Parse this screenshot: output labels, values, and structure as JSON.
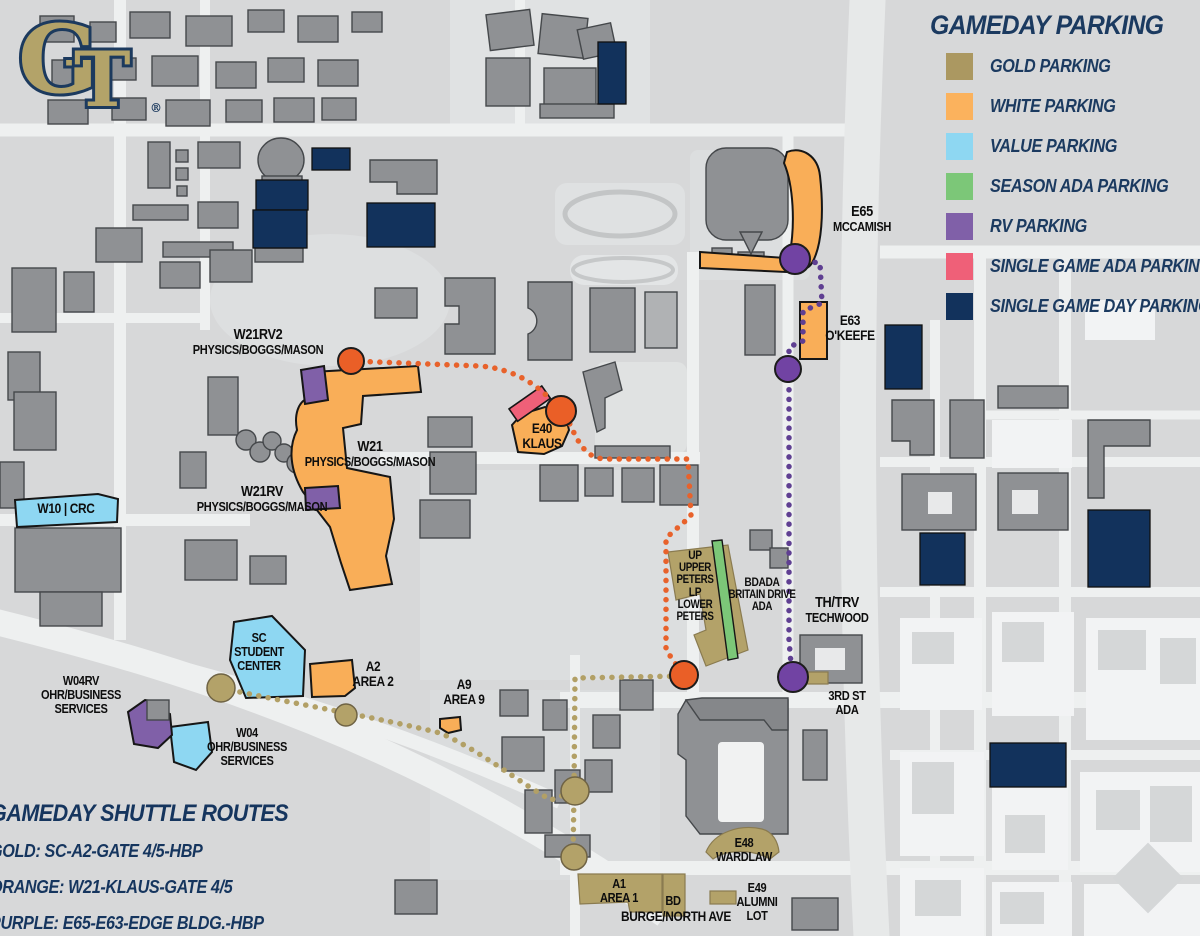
{
  "logo": {
    "g": "G",
    "t": "T",
    "reg": "®"
  },
  "legend": {
    "title": "GAMEDAY PARKING",
    "items": [
      {
        "label": "GOLD PARKING",
        "color": "#ab9861"
      },
      {
        "label": "WHITE PARKING",
        "color": "#fbb25d"
      },
      {
        "label": "VALUE PARKING",
        "color": "#8ed7f2"
      },
      {
        "label": "SEASON ADA PARKING",
        "color": "#7cc778"
      },
      {
        "label": "RV PARKING",
        "color": "#8060a8"
      },
      {
        "label": "SINGLE GAME ADA PARKING",
        "color": "#ef6078"
      },
      {
        "label": "SINGLE GAME DAY PARKING",
        "color": "#12325c"
      }
    ]
  },
  "shuttle": {
    "title": "GAMEDAY SHUTTLE ROUTES",
    "routes": [
      {
        "label": "GOLD: SC-A2-GATE 4/5-HBP"
      },
      {
        "label": "ORANGE: W21-KLAUS-GATE 4/5"
      },
      {
        "label": "PURPLE: E65-E63-EDGE BLDG.-HBP"
      }
    ]
  },
  "lots": {
    "w21rv2": {
      "lines": [
        "W21RV2",
        "PHYSICS/BOGGS/MASON"
      ]
    },
    "w21": {
      "lines": [
        "W21",
        "PHYSICS/BOGGS/MASON"
      ]
    },
    "w21rv": {
      "lines": [
        "W21RV",
        "PHYSICS/BOGGS/MASON"
      ]
    },
    "e40": {
      "lines": [
        "E40",
        "KLAUS"
      ]
    },
    "w10": {
      "lines": [
        "W10 | CRC"
      ]
    },
    "sc": {
      "lines": [
        "SC",
        "STUDENT",
        "CENTER"
      ]
    },
    "a2": {
      "lines": [
        "A2",
        "AREA 2"
      ]
    },
    "a9": {
      "lines": [
        "A9",
        "AREA 9"
      ]
    },
    "w04rv": {
      "lines": [
        "W04RV",
        "OHR/BUSINESS",
        "SERVICES"
      ]
    },
    "w04": {
      "lines": [
        "W04",
        "OHR/BUSINESS",
        "SERVICES"
      ]
    },
    "e65": {
      "lines": [
        "E65",
        "MCCAMISH"
      ]
    },
    "e63": {
      "lines": [
        "E63",
        "O'KEEFE"
      ]
    },
    "peters": {
      "lines": [
        "UP",
        "UPPER",
        "PETERS",
        "LP",
        "LOWER",
        "PETERS"
      ]
    },
    "bdada": {
      "lines": [
        "BDADA",
        "BRITAIN DRIVE",
        "ADA"
      ]
    },
    "thtrv": {
      "lines": [
        "TH/TRV",
        "TECHWOOD"
      ]
    },
    "third": {
      "lines": [
        "3RD ST",
        "ADA"
      ]
    },
    "e48": {
      "lines": [
        "E48",
        "WARDLAW"
      ]
    },
    "a1": {
      "lines": [
        "A1",
        "AREA 1"
      ]
    },
    "bd": {
      "lines": [
        "BD"
      ]
    },
    "burge": {
      "lines": [
        "BURGE/NORTH AVE"
      ]
    },
    "e49": {
      "lines": [
        "E49",
        "ALUMNI",
        "LOT"
      ]
    }
  }
}
